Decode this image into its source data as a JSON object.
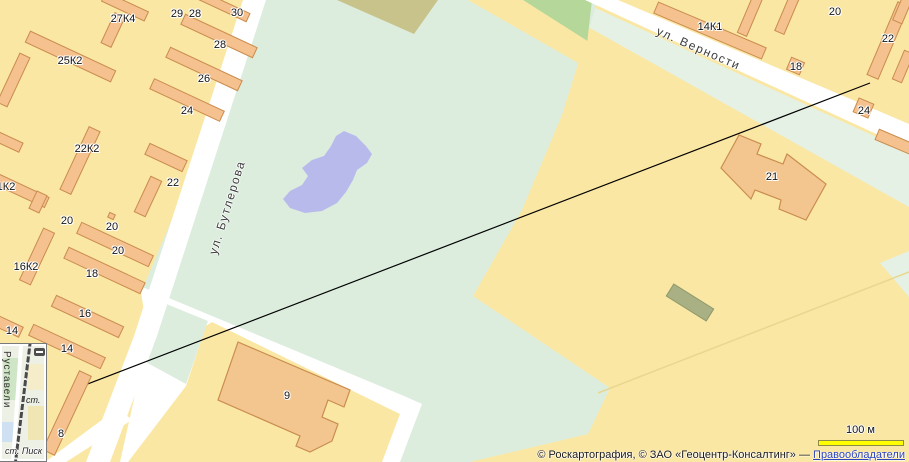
{
  "map": {
    "streets": [
      {
        "name": "ул. Бутлерова"
      },
      {
        "name": "ул. Верности"
      }
    ],
    "building_labels": [
      {
        "text": "27К4",
        "x": 123,
        "y": 19
      },
      {
        "text": "29",
        "x": 177,
        "y": 14
      },
      {
        "text": "28",
        "x": 195,
        "y": 14
      },
      {
        "text": "30",
        "x": 237,
        "y": 13
      },
      {
        "text": "25К2",
        "x": 70,
        "y": 61
      },
      {
        "text": "28",
        "x": 220,
        "y": 45
      },
      {
        "text": "26",
        "x": 204,
        "y": 79
      },
      {
        "text": "24",
        "x": 187,
        "y": 111
      },
      {
        "text": "22К2",
        "x": 87,
        "y": 149
      },
      {
        "text": "1К2",
        "x": 6,
        "y": 187
      },
      {
        "text": "22",
        "x": 173,
        "y": 183
      },
      {
        "text": "20",
        "x": 67,
        "y": 221
      },
      {
        "text": "20",
        "x": 112,
        "y": 227
      },
      {
        "text": "20",
        "x": 118,
        "y": 251
      },
      {
        "text": "16К2",
        "x": 26,
        "y": 267
      },
      {
        "text": "18",
        "x": 92,
        "y": 274
      },
      {
        "text": "16",
        "x": 85,
        "y": 314
      },
      {
        "text": "14",
        "x": 12,
        "y": 331
      },
      {
        "text": "14",
        "x": 67,
        "y": 349
      },
      {
        "text": "8",
        "x": 61,
        "y": 434
      },
      {
        "text": "9",
        "x": 287,
        "y": 396
      },
      {
        "text": "21",
        "x": 772,
        "y": 177
      },
      {
        "text": "14К1",
        "x": 710,
        "y": 27
      },
      {
        "text": "20",
        "x": 835,
        "y": 12
      },
      {
        "text": "22",
        "x": 888,
        "y": 39
      },
      {
        "text": "18",
        "x": 796,
        "y": 67
      },
      {
        "text": "24",
        "x": 864,
        "y": 111
      }
    ],
    "colors": {
      "base": "#fbe7a4",
      "park": "#dcedde",
      "green_strip": "#e4f1e4",
      "pond": "#b9baec",
      "road": "#ffffff",
      "building_fill": "#f5c28f",
      "building_border": "#c98d4f",
      "woodland": "#b5d89a",
      "khaki_area": "#c8c38b",
      "olive_building": "#a9b184",
      "link": "#2b44bb",
      "scale_bar": "#ffff00"
    }
  },
  "inset": {
    "street": "Руставели",
    "station_short": "ст.",
    "station": "ст. Писк",
    "zoom_out_glyph": ""
  },
  "scale": {
    "label": "100 м"
  },
  "attribution": {
    "prefix": "© Роскартография, © ЗАО «Геоцентр-Консалтинг» — ",
    "link": "Правообладатели"
  }
}
